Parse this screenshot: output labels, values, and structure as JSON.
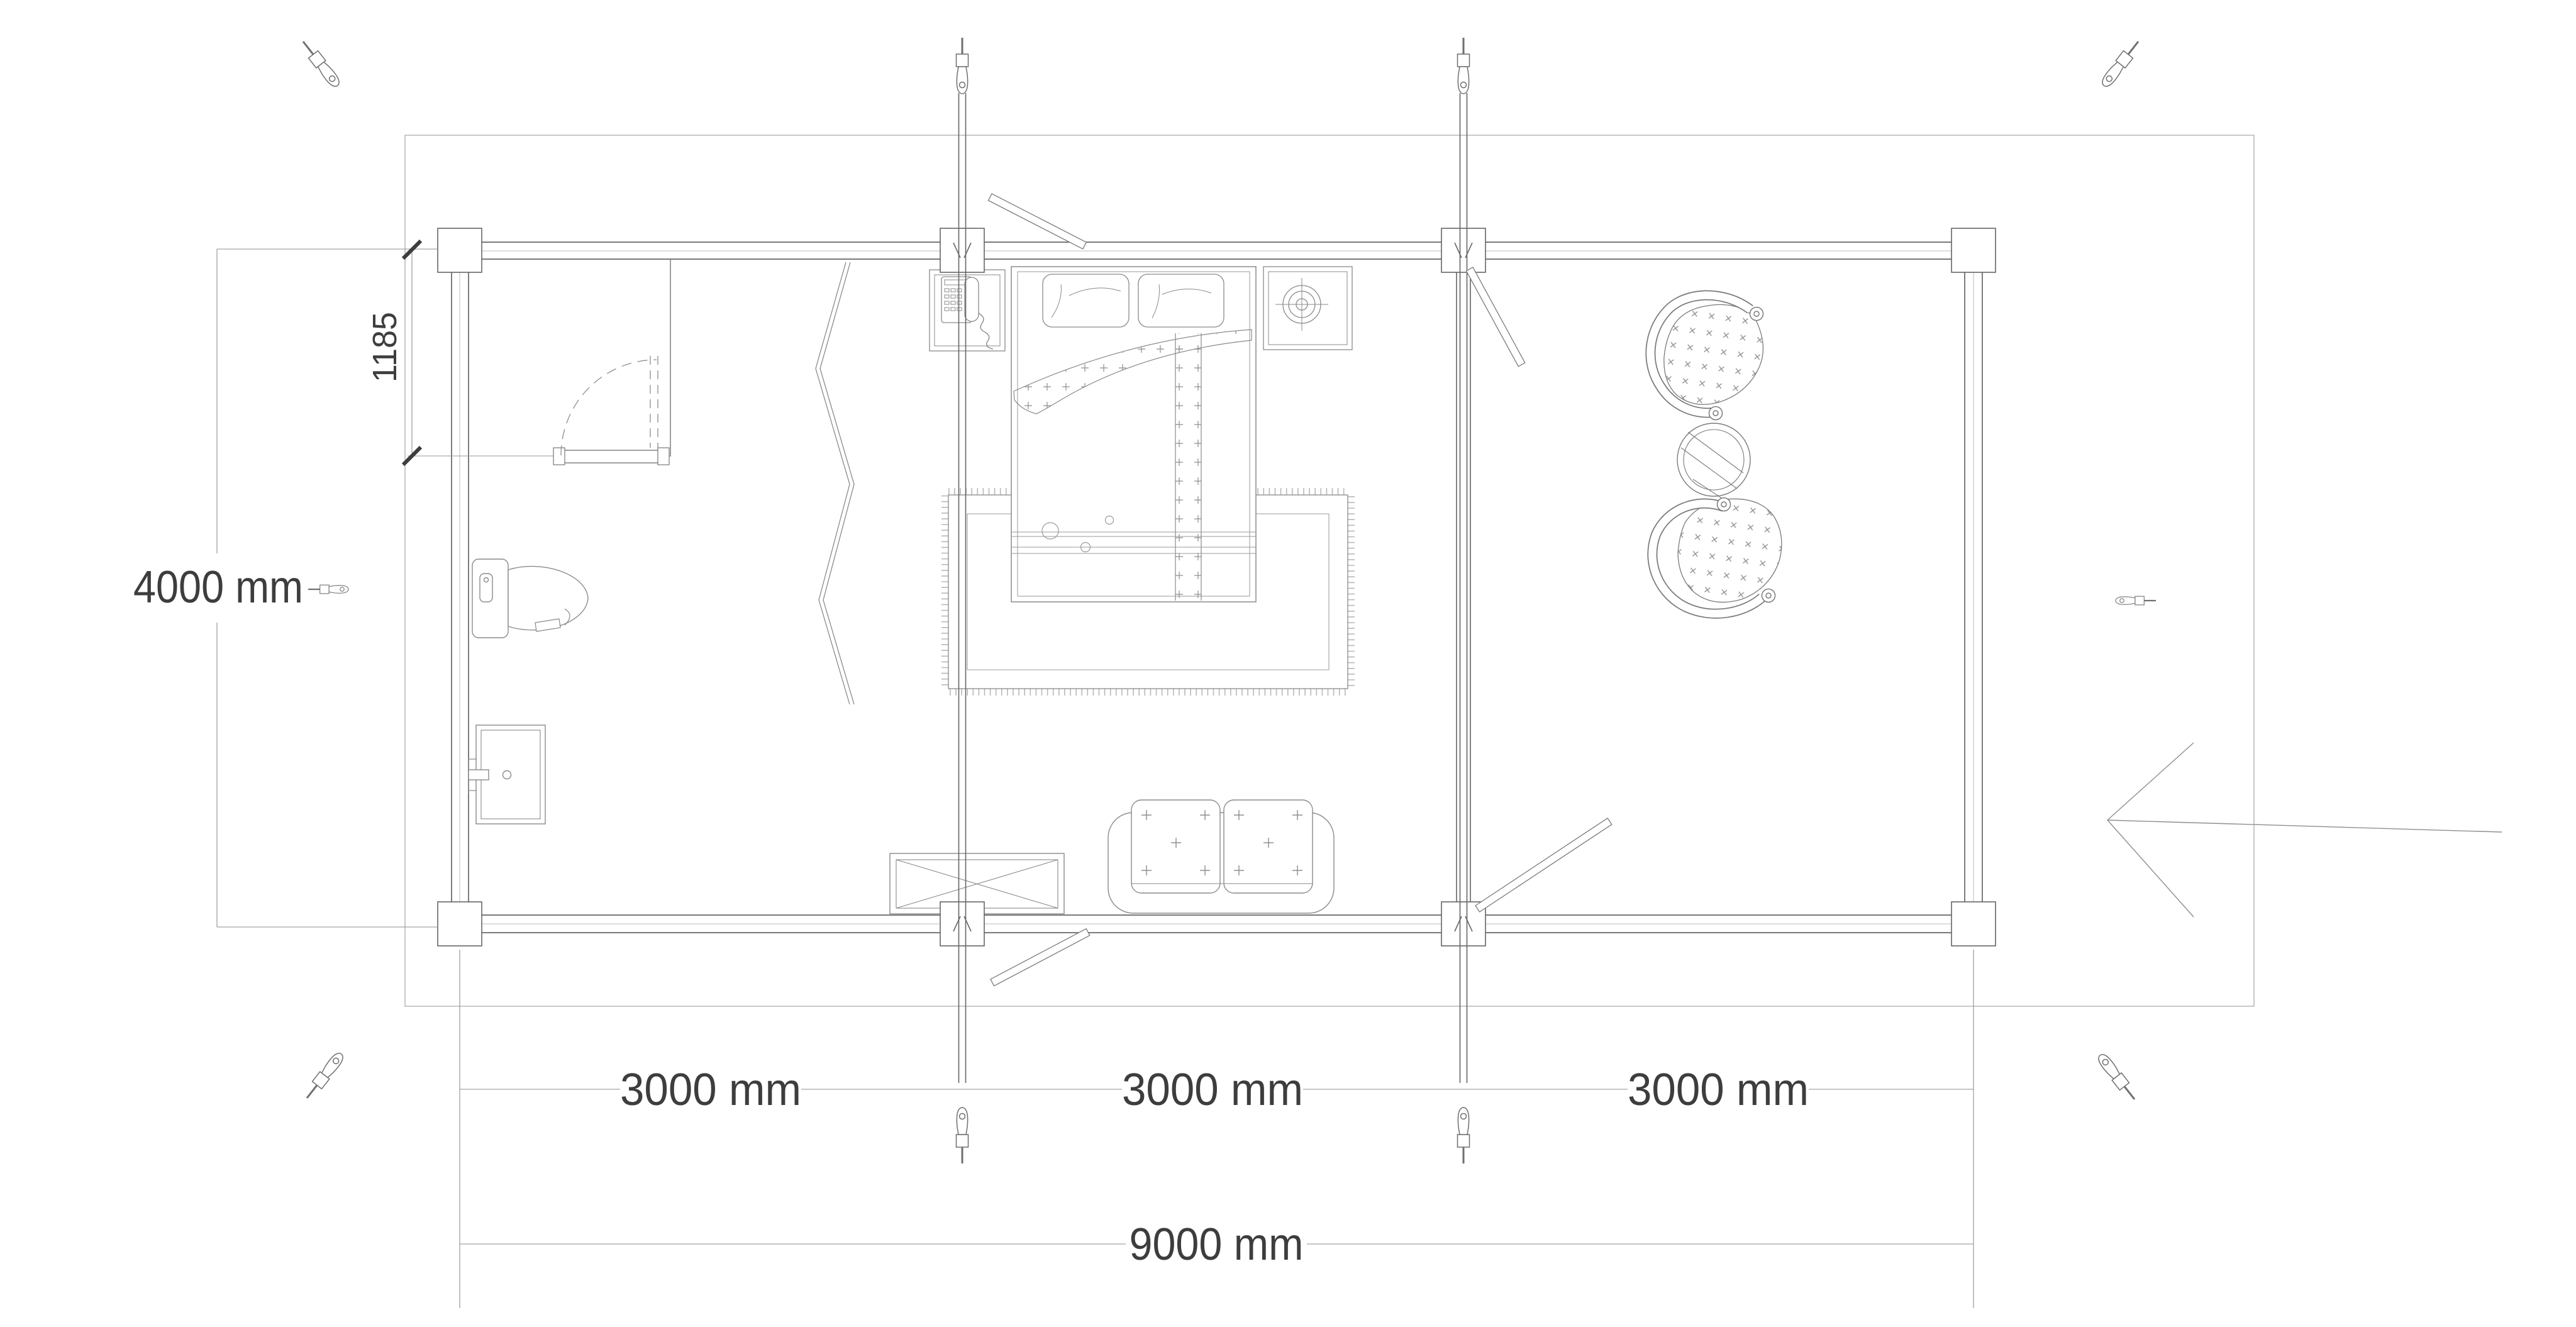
{
  "plan": {
    "dim_depth": "4000 mm",
    "dim_door_offset": "1185",
    "dim_bays": [
      "3000 mm",
      "3000 mm",
      "3000 mm"
    ],
    "dim_total": "9000 mm"
  },
  "icons": {
    "corner_fastener": "eye-bolt-screw",
    "storm_brace": "threaded-rod-with-eye-bolt-ends",
    "entrance": "left-pointing-arrow"
  },
  "colors": {
    "background": "#ffffff",
    "line": "#6f6f6f",
    "line_light": "#a5a5a5",
    "furniture": "#8a8a8a",
    "text": "#3d3d3d"
  }
}
